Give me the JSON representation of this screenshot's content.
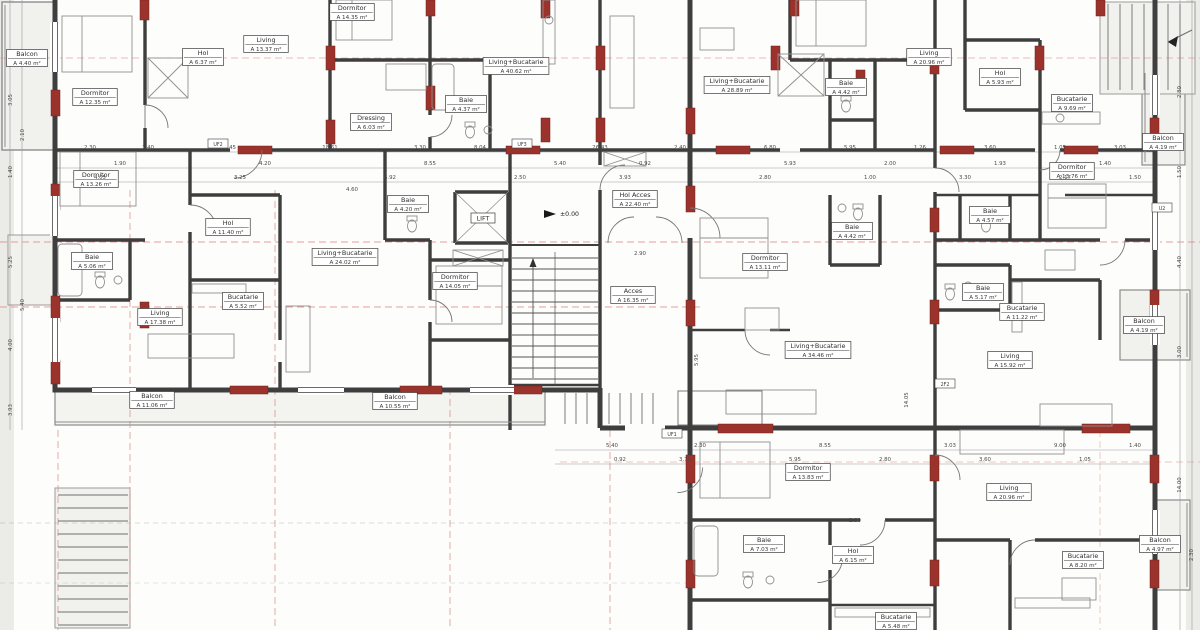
{
  "plan": {
    "level_marker": "±0.00",
    "rooms": [
      {
        "id": "balcon-tl",
        "name": "Balcon",
        "area": "A 4.40 m²",
        "x": 27,
        "y": 58
      },
      {
        "id": "dormitor-tl",
        "name": "Dormitor",
        "area": "A 12.35 m²",
        "x": 95,
        "y": 97
      },
      {
        "id": "hol-tl",
        "name": "Hol",
        "area": "A 6.37 m²",
        "x": 203,
        "y": 57
      },
      {
        "id": "living-tl",
        "name": "Living",
        "area": "A 13.37 m²",
        "x": 266,
        "y": 44
      },
      {
        "id": "dormitor-tm",
        "name": "Dormitor",
        "area": "A 14.35 m²",
        "x": 352,
        "y": 12
      },
      {
        "id": "dressing-tm",
        "name": "Dressing",
        "area": "A 6.03 m²",
        "x": 371,
        "y": 122
      },
      {
        "id": "baie-tm",
        "name": "Baie",
        "area": "A 4.37 m²",
        "x": 466,
        "y": 104
      },
      {
        "id": "living-bucatarie-tm",
        "name": "Living+Bucatarie",
        "area": "A 40.62 m²",
        "x": 516,
        "y": 66
      },
      {
        "id": "living-bucatarie-tc",
        "name": "Living+Bucatarie",
        "area": "A 28.89 m²",
        "x": 737,
        "y": 85
      },
      {
        "id": "baie-tc",
        "name": "Baie",
        "area": "A 4.42 m²",
        "x": 846,
        "y": 87
      },
      {
        "id": "living-tr",
        "name": "Living",
        "area": "A 20.96 m²",
        "x": 929,
        "y": 57
      },
      {
        "id": "hol-tr",
        "name": "Hol",
        "area": "A 5.93 m²",
        "x": 1000,
        "y": 77
      },
      {
        "id": "bucatarie-tr",
        "name": "Bucatarie",
        "area": "A 9.69 m²",
        "x": 1072,
        "y": 103
      },
      {
        "id": "balcon-tr",
        "name": "Balcon",
        "area": "A 4.19 m²",
        "x": 1163,
        "y": 142
      },
      {
        "id": "dormitor-tr",
        "name": "Dormitor",
        "area": "A 13.76 m²",
        "x": 1072,
        "y": 171
      },
      {
        "id": "dormitor-ml",
        "name": "Dormitor",
        "area": "A 13.26 m²",
        "x": 96,
        "y": 179
      },
      {
        "id": "hol-ml",
        "name": "Hol",
        "area": "A 11.40 m²",
        "x": 228,
        "y": 227
      },
      {
        "id": "baie-ml",
        "name": "Baie",
        "area": "A 5.06 m²",
        "x": 92,
        "y": 261
      },
      {
        "id": "bucatarie-ml",
        "name": "Bucatarie",
        "area": "A 5.52 m²",
        "x": 243,
        "y": 301
      },
      {
        "id": "living-ml",
        "name": "Living",
        "area": "A 17.38 m²",
        "x": 160,
        "y": 317
      },
      {
        "id": "baie-mm",
        "name": "Baie",
        "area": "A 4.20 m²",
        "x": 408,
        "y": 204
      },
      {
        "id": "living-bucatarie-mm",
        "name": "Living+Bucatarie",
        "area": "A 24.02 m²",
        "x": 345,
        "y": 257
      },
      {
        "id": "dormitor-mm",
        "name": "Dormitor",
        "area": "A 14.05 m²",
        "x": 455,
        "y": 281
      },
      {
        "id": "lift",
        "name": "LIFT",
        "area": null,
        "x": 483,
        "y": 218
      },
      {
        "id": "hol-acces",
        "name": "Hol Acces",
        "area": "A 22.40 m²",
        "x": 635,
        "y": 199
      },
      {
        "id": "acces",
        "name": "Acces",
        "area": "A 16.35 m²",
        "x": 633,
        "y": 295
      },
      {
        "id": "dormitor-mr",
        "name": "Dormitor",
        "area": "A 13.11 m²",
        "x": 765,
        "y": 262
      },
      {
        "id": "baie-mr",
        "name": "Baie",
        "area": "A 4.42 m²",
        "x": 852,
        "y": 231
      },
      {
        "id": "living-bucatarie-mr",
        "name": "Living+Bucatarie",
        "area": "A 34.46 m²",
        "x": 818,
        "y": 350
      },
      {
        "id": "baie-rr-sus",
        "name": "Baie",
        "area": "A 4.57 m²",
        "x": 990,
        "y": 215
      },
      {
        "id": "baie-rr",
        "name": "Baie",
        "area": "A 5.17 m²",
        "x": 983,
        "y": 292
      },
      {
        "id": "bucatarie-rr",
        "name": "Bucatarie",
        "area": "A 11.22 m²",
        "x": 1022,
        "y": 312
      },
      {
        "id": "living-rr",
        "name": "Living",
        "area": "A 15.92 m²",
        "x": 1010,
        "y": 360
      },
      {
        "id": "balcon-rr",
        "name": "Balcon",
        "area": "A 4.19 m²",
        "x": 1144,
        "y": 325
      },
      {
        "id": "balcon-bl-1",
        "name": "Balcon",
        "area": "A 11.06 m²",
        "x": 152,
        "y": 400
      },
      {
        "id": "balcon-bl-2",
        "name": "Balcon",
        "area": "A 10.55 m²",
        "x": 395,
        "y": 401
      },
      {
        "id": "dormitor-br",
        "name": "Dormitor",
        "area": "A 13.83 m²",
        "x": 808,
        "y": 472
      },
      {
        "id": "baie-br",
        "name": "Baie",
        "area": "A 7.03 m²",
        "x": 764,
        "y": 544
      },
      {
        "id": "hol-br",
        "name": "Hol",
        "area": "A 6.15 m²",
        "x": 853,
        "y": 555
      },
      {
        "id": "bucatarie-br-1",
        "name": "Bucatarie",
        "area": "A 5.48 m²",
        "x": 896,
        "y": 621
      },
      {
        "id": "living-br",
        "name": "Living",
        "area": "A 20.96 m²",
        "x": 1009,
        "y": 492
      },
      {
        "id": "bucatarie-br-2",
        "name": "Bucatarie",
        "area": "A 8.20 m²",
        "x": 1083,
        "y": 560
      },
      {
        "id": "balcon-br",
        "name": "Balcon",
        "area": "A 4.97 m²",
        "x": 1160,
        "y": 544
      }
    ],
    "dimensions": [
      {
        "t": "2.30",
        "x": 90,
        "y": 149
      },
      {
        "t": "1.40",
        "x": 148,
        "y": 149
      },
      {
        "t": "5.45",
        "x": 230,
        "y": 149
      },
      {
        "t": "18.61",
        "x": 330,
        "y": 149
      },
      {
        "t": "3.30",
        "x": 420,
        "y": 149
      },
      {
        "t": "8.04",
        "x": 480,
        "y": 149
      },
      {
        "t": "26.43",
        "x": 600,
        "y": 149
      },
      {
        "t": "2.40",
        "x": 680,
        "y": 149
      },
      {
        "t": "6.80",
        "x": 770,
        "y": 149
      },
      {
        "t": "5.95",
        "x": 850,
        "y": 149
      },
      {
        "t": "1.26",
        "x": 920,
        "y": 149
      },
      {
        "t": "3.60",
        "x": 990,
        "y": 149
      },
      {
        "t": "1.05",
        "x": 1060,
        "y": 149
      },
      {
        "t": "3.03",
        "x": 1120,
        "y": 149
      },
      {
        "t": "1.90",
        "x": 120,
        "y": 165
      },
      {
        "t": "4.20",
        "x": 265,
        "y": 165
      },
      {
        "t": "8.55",
        "x": 430,
        "y": 165
      },
      {
        "t": "5.40",
        "x": 560,
        "y": 165
      },
      {
        "t": "0.92",
        "x": 645,
        "y": 165
      },
      {
        "t": "5.93",
        "x": 790,
        "y": 165
      },
      {
        "t": "2.00",
        "x": 890,
        "y": 165
      },
      {
        "t": "1.93",
        "x": 1000,
        "y": 165
      },
      {
        "t": "1.40",
        "x": 1105,
        "y": 165
      },
      {
        "t": "4.05",
        "x": 100,
        "y": 179
      },
      {
        "t": "3.25",
        "x": 240,
        "y": 179
      },
      {
        "t": "6.92",
        "x": 390,
        "y": 179
      },
      {
        "t": "2.50",
        "x": 520,
        "y": 179
      },
      {
        "t": "3.93",
        "x": 625,
        "y": 179
      },
      {
        "t": "2.80",
        "x": 765,
        "y": 179
      },
      {
        "t": "1.00",
        "x": 870,
        "y": 179
      },
      {
        "t": "3.30",
        "x": 965,
        "y": 179
      },
      {
        "t": "2.17",
        "x": 1065,
        "y": 179
      },
      {
        "t": "1.50",
        "x": 1135,
        "y": 179
      },
      {
        "t": "5.40",
        "x": 612,
        "y": 447
      },
      {
        "t": "2.30",
        "x": 700,
        "y": 447
      },
      {
        "t": "8.55",
        "x": 825,
        "y": 447
      },
      {
        "t": "3.03",
        "x": 950,
        "y": 447
      },
      {
        "t": "9.00",
        "x": 1060,
        "y": 447
      },
      {
        "t": "1.40",
        "x": 1135,
        "y": 447
      },
      {
        "t": "0.92",
        "x": 620,
        "y": 461
      },
      {
        "t": "3.75",
        "x": 685,
        "y": 461
      },
      {
        "t": "5.95",
        "x": 795,
        "y": 461
      },
      {
        "t": "2.80",
        "x": 885,
        "y": 461
      },
      {
        "t": "3.60",
        "x": 985,
        "y": 461
      },
      {
        "t": "1.05",
        "x": 1085,
        "y": 461
      },
      {
        "t": "3.05",
        "x": 12,
        "y": 100,
        "r": -90
      },
      {
        "t": "1.40",
        "x": 12,
        "y": 172,
        "r": -90
      },
      {
        "t": "5.25",
        "x": 12,
        "y": 262,
        "r": -90
      },
      {
        "t": "4.00",
        "x": 12,
        "y": 345,
        "r": -90
      },
      {
        "t": "3.93",
        "x": 12,
        "y": 410,
        "r": -90
      },
      {
        "t": "2.10",
        "x": 24,
        "y": 135,
        "r": -90
      },
      {
        "t": "5.40",
        "x": 24,
        "y": 305,
        "r": -90
      },
      {
        "t": "2.80",
        "x": 1181,
        "y": 92,
        "r": -90
      },
      {
        "t": "1.50",
        "x": 1181,
        "y": 172,
        "r": -90
      },
      {
        "t": "4.40",
        "x": 1181,
        "y": 262,
        "r": -90
      },
      {
        "t": "3.00",
        "x": 1181,
        "y": 352,
        "r": -90
      },
      {
        "t": "14.00",
        "x": 1181,
        "y": 485,
        "r": -90
      },
      {
        "t": "2.30",
        "x": 1193,
        "y": 555,
        "r": -90
      },
      {
        "t": "4.60",
        "x": 352,
        "y": 191
      },
      {
        "t": "2.80",
        "x": 855,
        "y": 522
      },
      {
        "t": "14.05",
        "x": 908,
        "y": 400,
        "r": -90
      },
      {
        "t": "5.95",
        "x": 698,
        "y": 360,
        "r": -90
      },
      {
        "t": "2.90",
        "x": 640,
        "y": 255
      }
    ],
    "tags": [
      {
        "t": "UF2",
        "x": 218,
        "y": 144
      },
      {
        "t": "UF3",
        "x": 522,
        "y": 144
      },
      {
        "t": "UF1",
        "x": 672,
        "y": 434
      },
      {
        "t": "2F2",
        "x": 945,
        "y": 384
      },
      {
        "t": "U2",
        "x": 1162,
        "y": 208
      }
    ],
    "colors": {
      "wall": "#3e3e3e",
      "structural_red": "#9b332c",
      "axis_red": "#dd8f88",
      "furniture": "#8f8f8f"
    }
  }
}
